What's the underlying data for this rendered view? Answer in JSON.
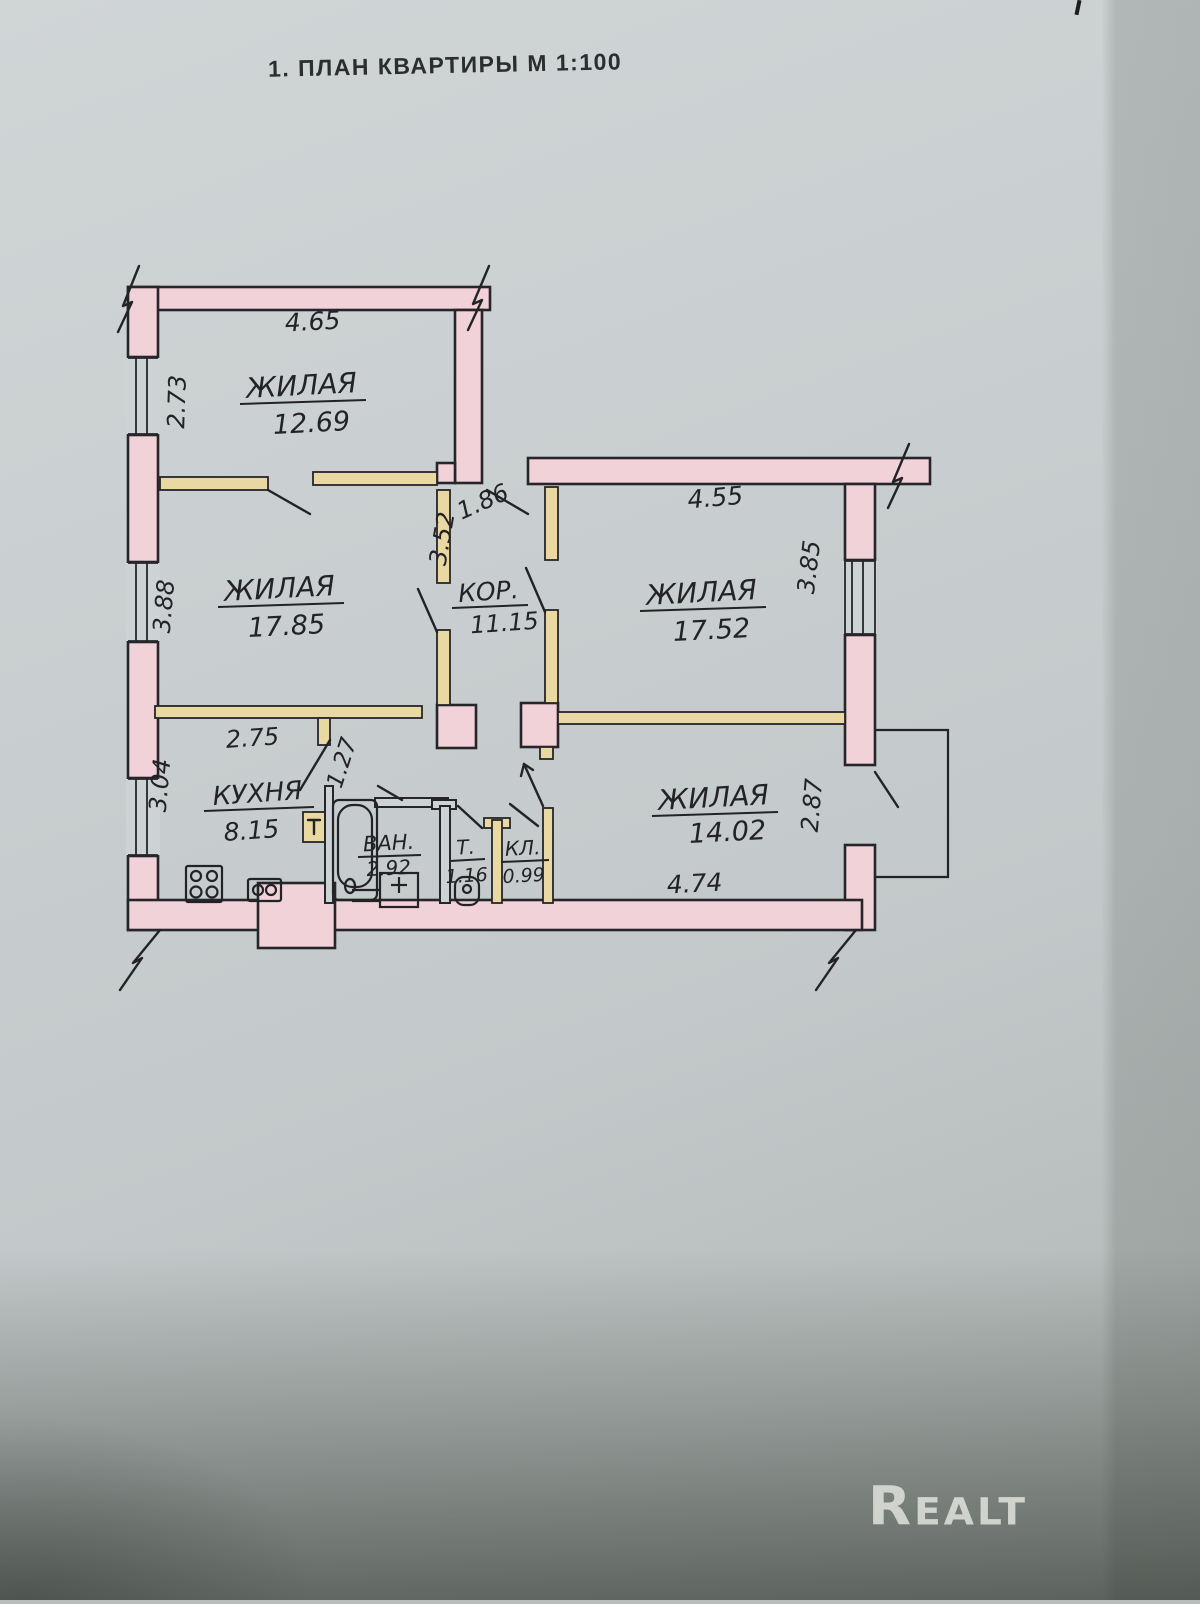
{
  "document": {
    "title": "1. ПЛАН КВАРТИРЫ М 1:100",
    "watermark": "Realt"
  },
  "colors": {
    "paper": "#c9cfd0",
    "wall_fill": "#f1d2d8",
    "partition_fill": "#e9d8a2",
    "ink": "#232327"
  },
  "rooms": [
    {
      "name": "ЖИЛАЯ",
      "area": "12.69"
    },
    {
      "name": "ЖИЛАЯ",
      "area": "17.85"
    },
    {
      "name": "КОР.",
      "area": "11.15"
    },
    {
      "name": "ЖИЛАЯ",
      "area": "17.52"
    },
    {
      "name": "КУХНЯ",
      "area": "8.15"
    },
    {
      "name": "ВАН.",
      "area": "2.92"
    },
    {
      "name": "Т.",
      "area": "1.16"
    },
    {
      "name": "КЛ.",
      "area": "0.99"
    },
    {
      "name": "ЖИЛАЯ",
      "area": "14.02"
    }
  ],
  "dimensions": {
    "room1_width": "4.65",
    "room1_depth": "2.73",
    "room2_depth": "3.88",
    "corridor_width": "1.86",
    "corridor_depth": "3.52",
    "room3_width": "4.55",
    "room3_depth": "3.85",
    "kitchen_width": "2.75",
    "kitchen_depth": "3.04",
    "kitchen_door": "1.27",
    "room4_width": "4.74",
    "room4_depth": "2.87"
  }
}
